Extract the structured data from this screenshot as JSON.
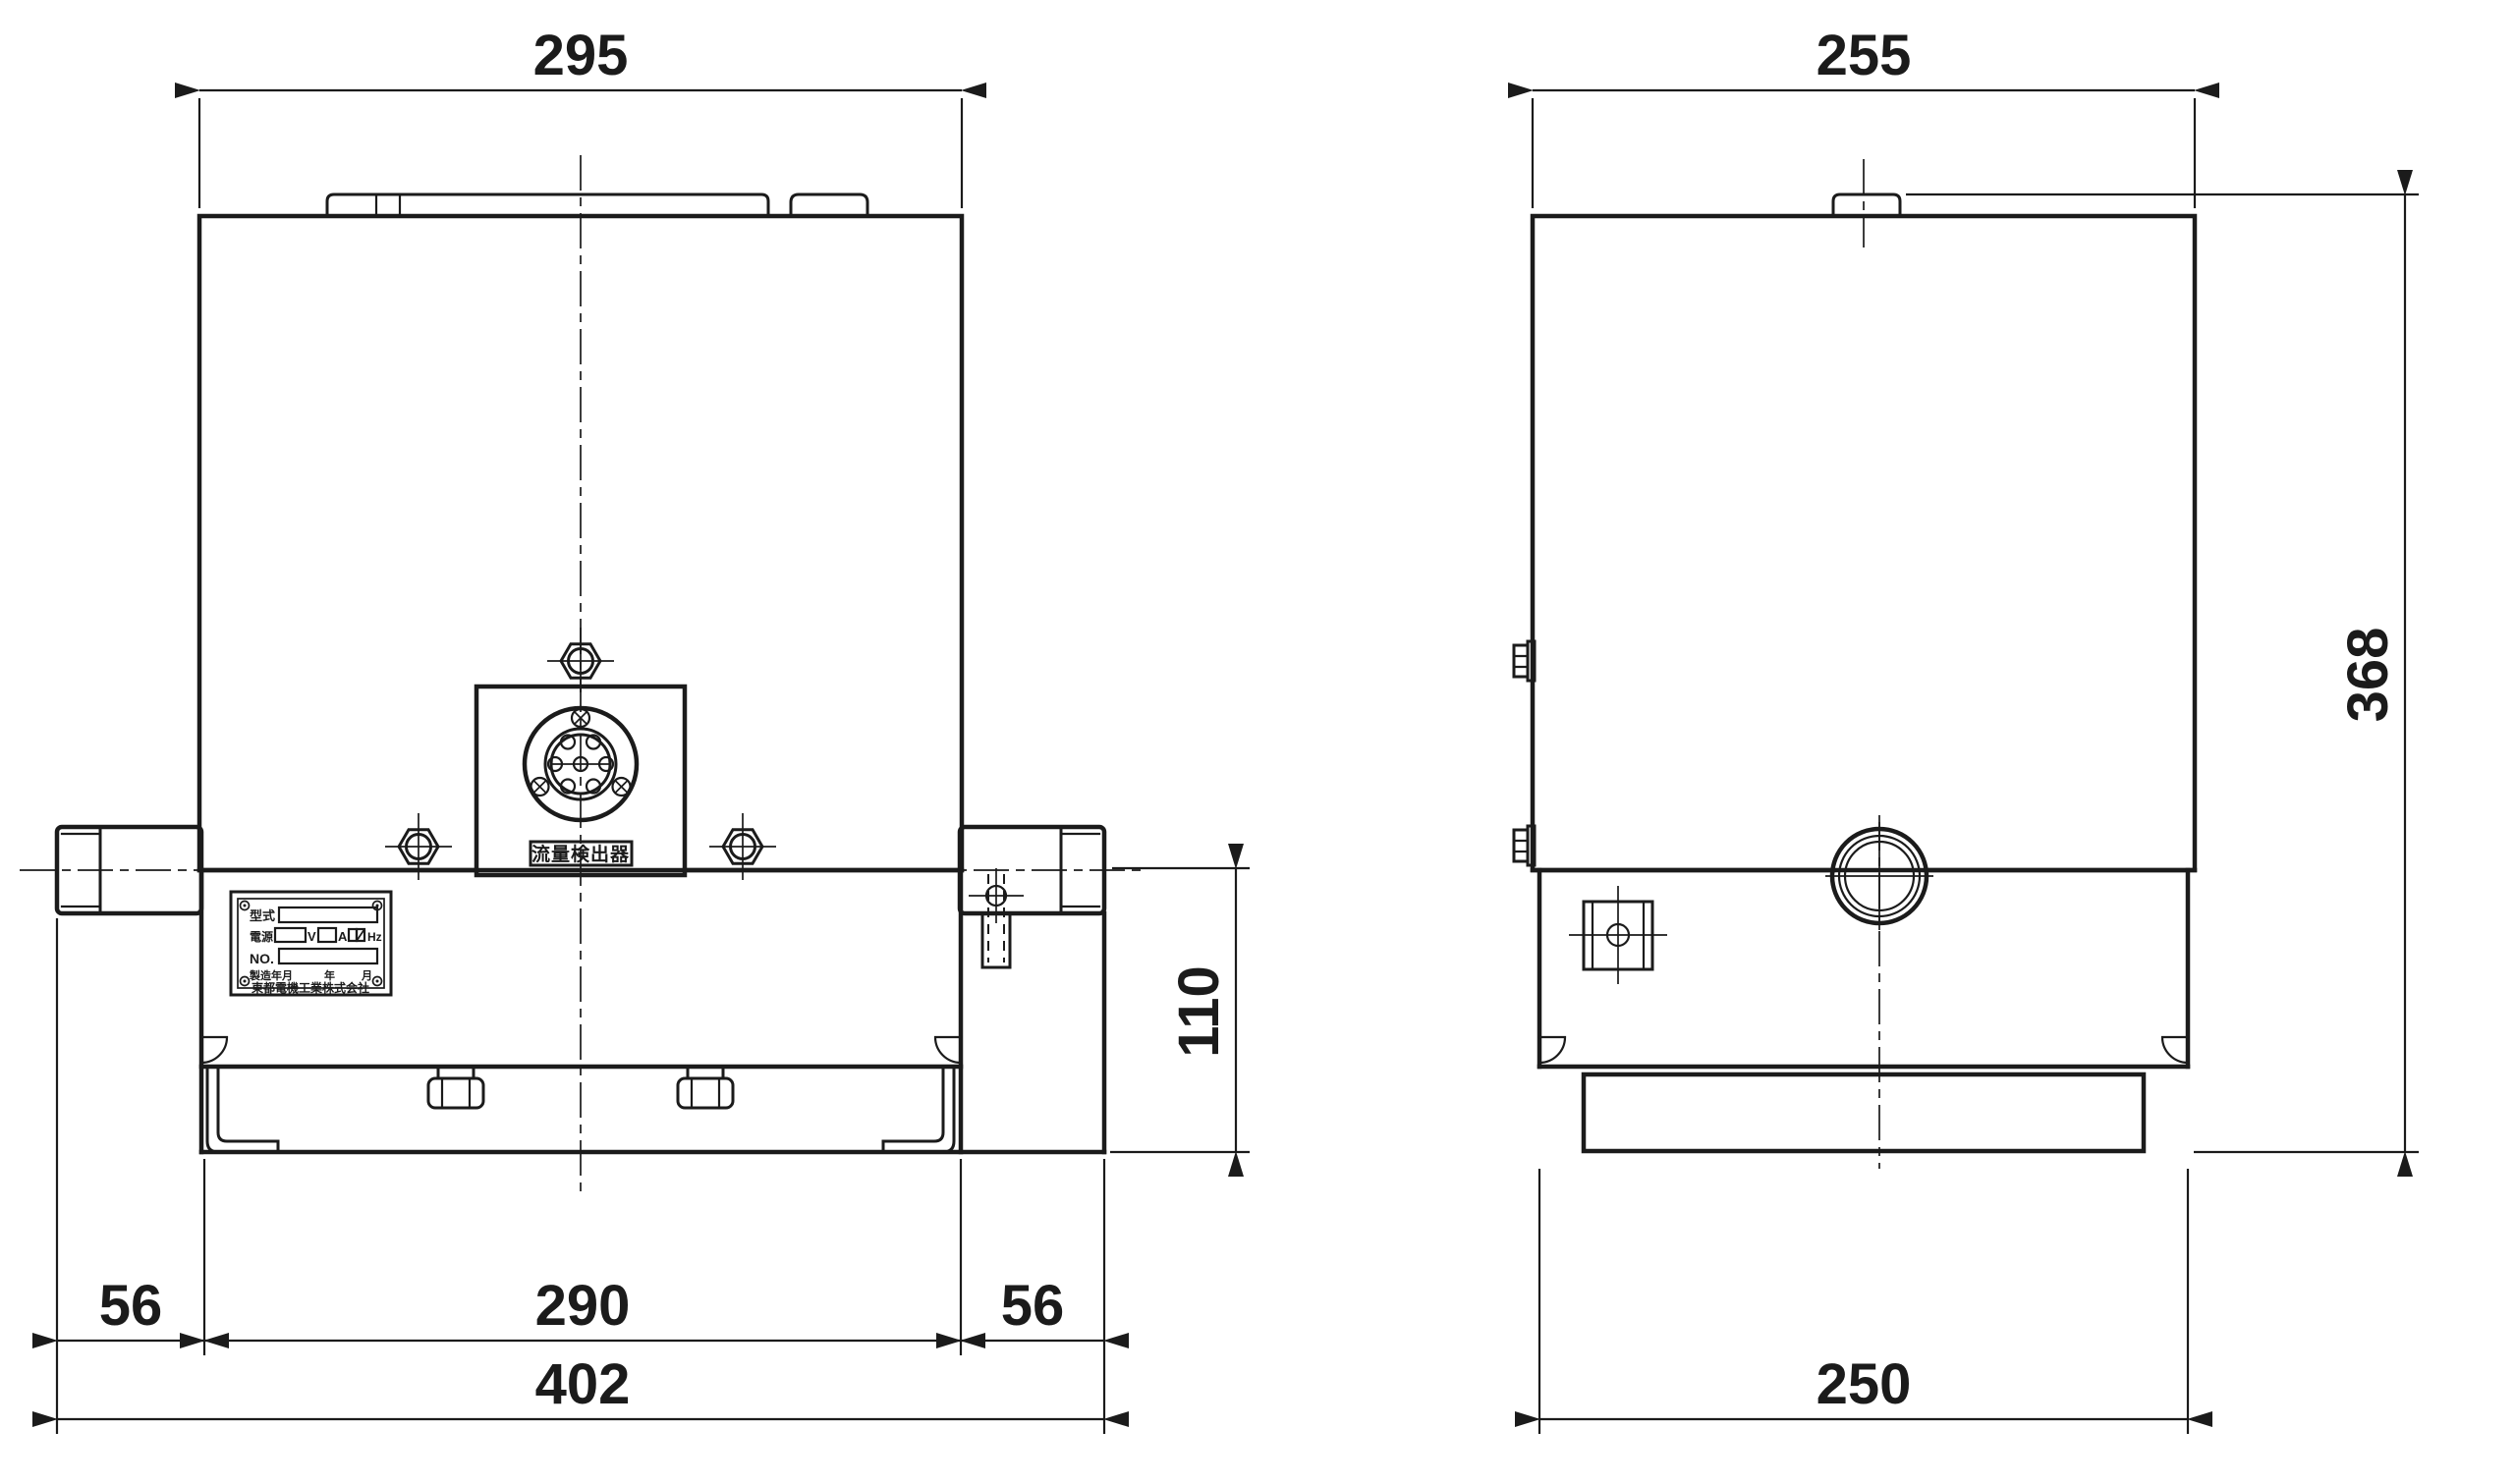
{
  "colors": {
    "line": "#1b1b1b",
    "background": "#ffffff"
  },
  "front_view": {
    "dims": {
      "top_width": "295",
      "bottom_left": "56",
      "bottom_center": "290",
      "bottom_right": "56",
      "bottom_overall": "402",
      "lower_height": "110"
    },
    "connector_label": "流量検出器",
    "nameplate": {
      "model_label": "型式",
      "power_label": "電源",
      "volt_unit": "V",
      "amp_unit": "A",
      "freq_unit": "Hz",
      "serial_label": "NO.",
      "date_label": "製造年月",
      "year_label": "年",
      "month_label": "月",
      "company": "東都電機工業株式会社"
    }
  },
  "side_view": {
    "dims": {
      "top_width": "255",
      "overall_height": "368",
      "bottom_width": "250"
    }
  }
}
